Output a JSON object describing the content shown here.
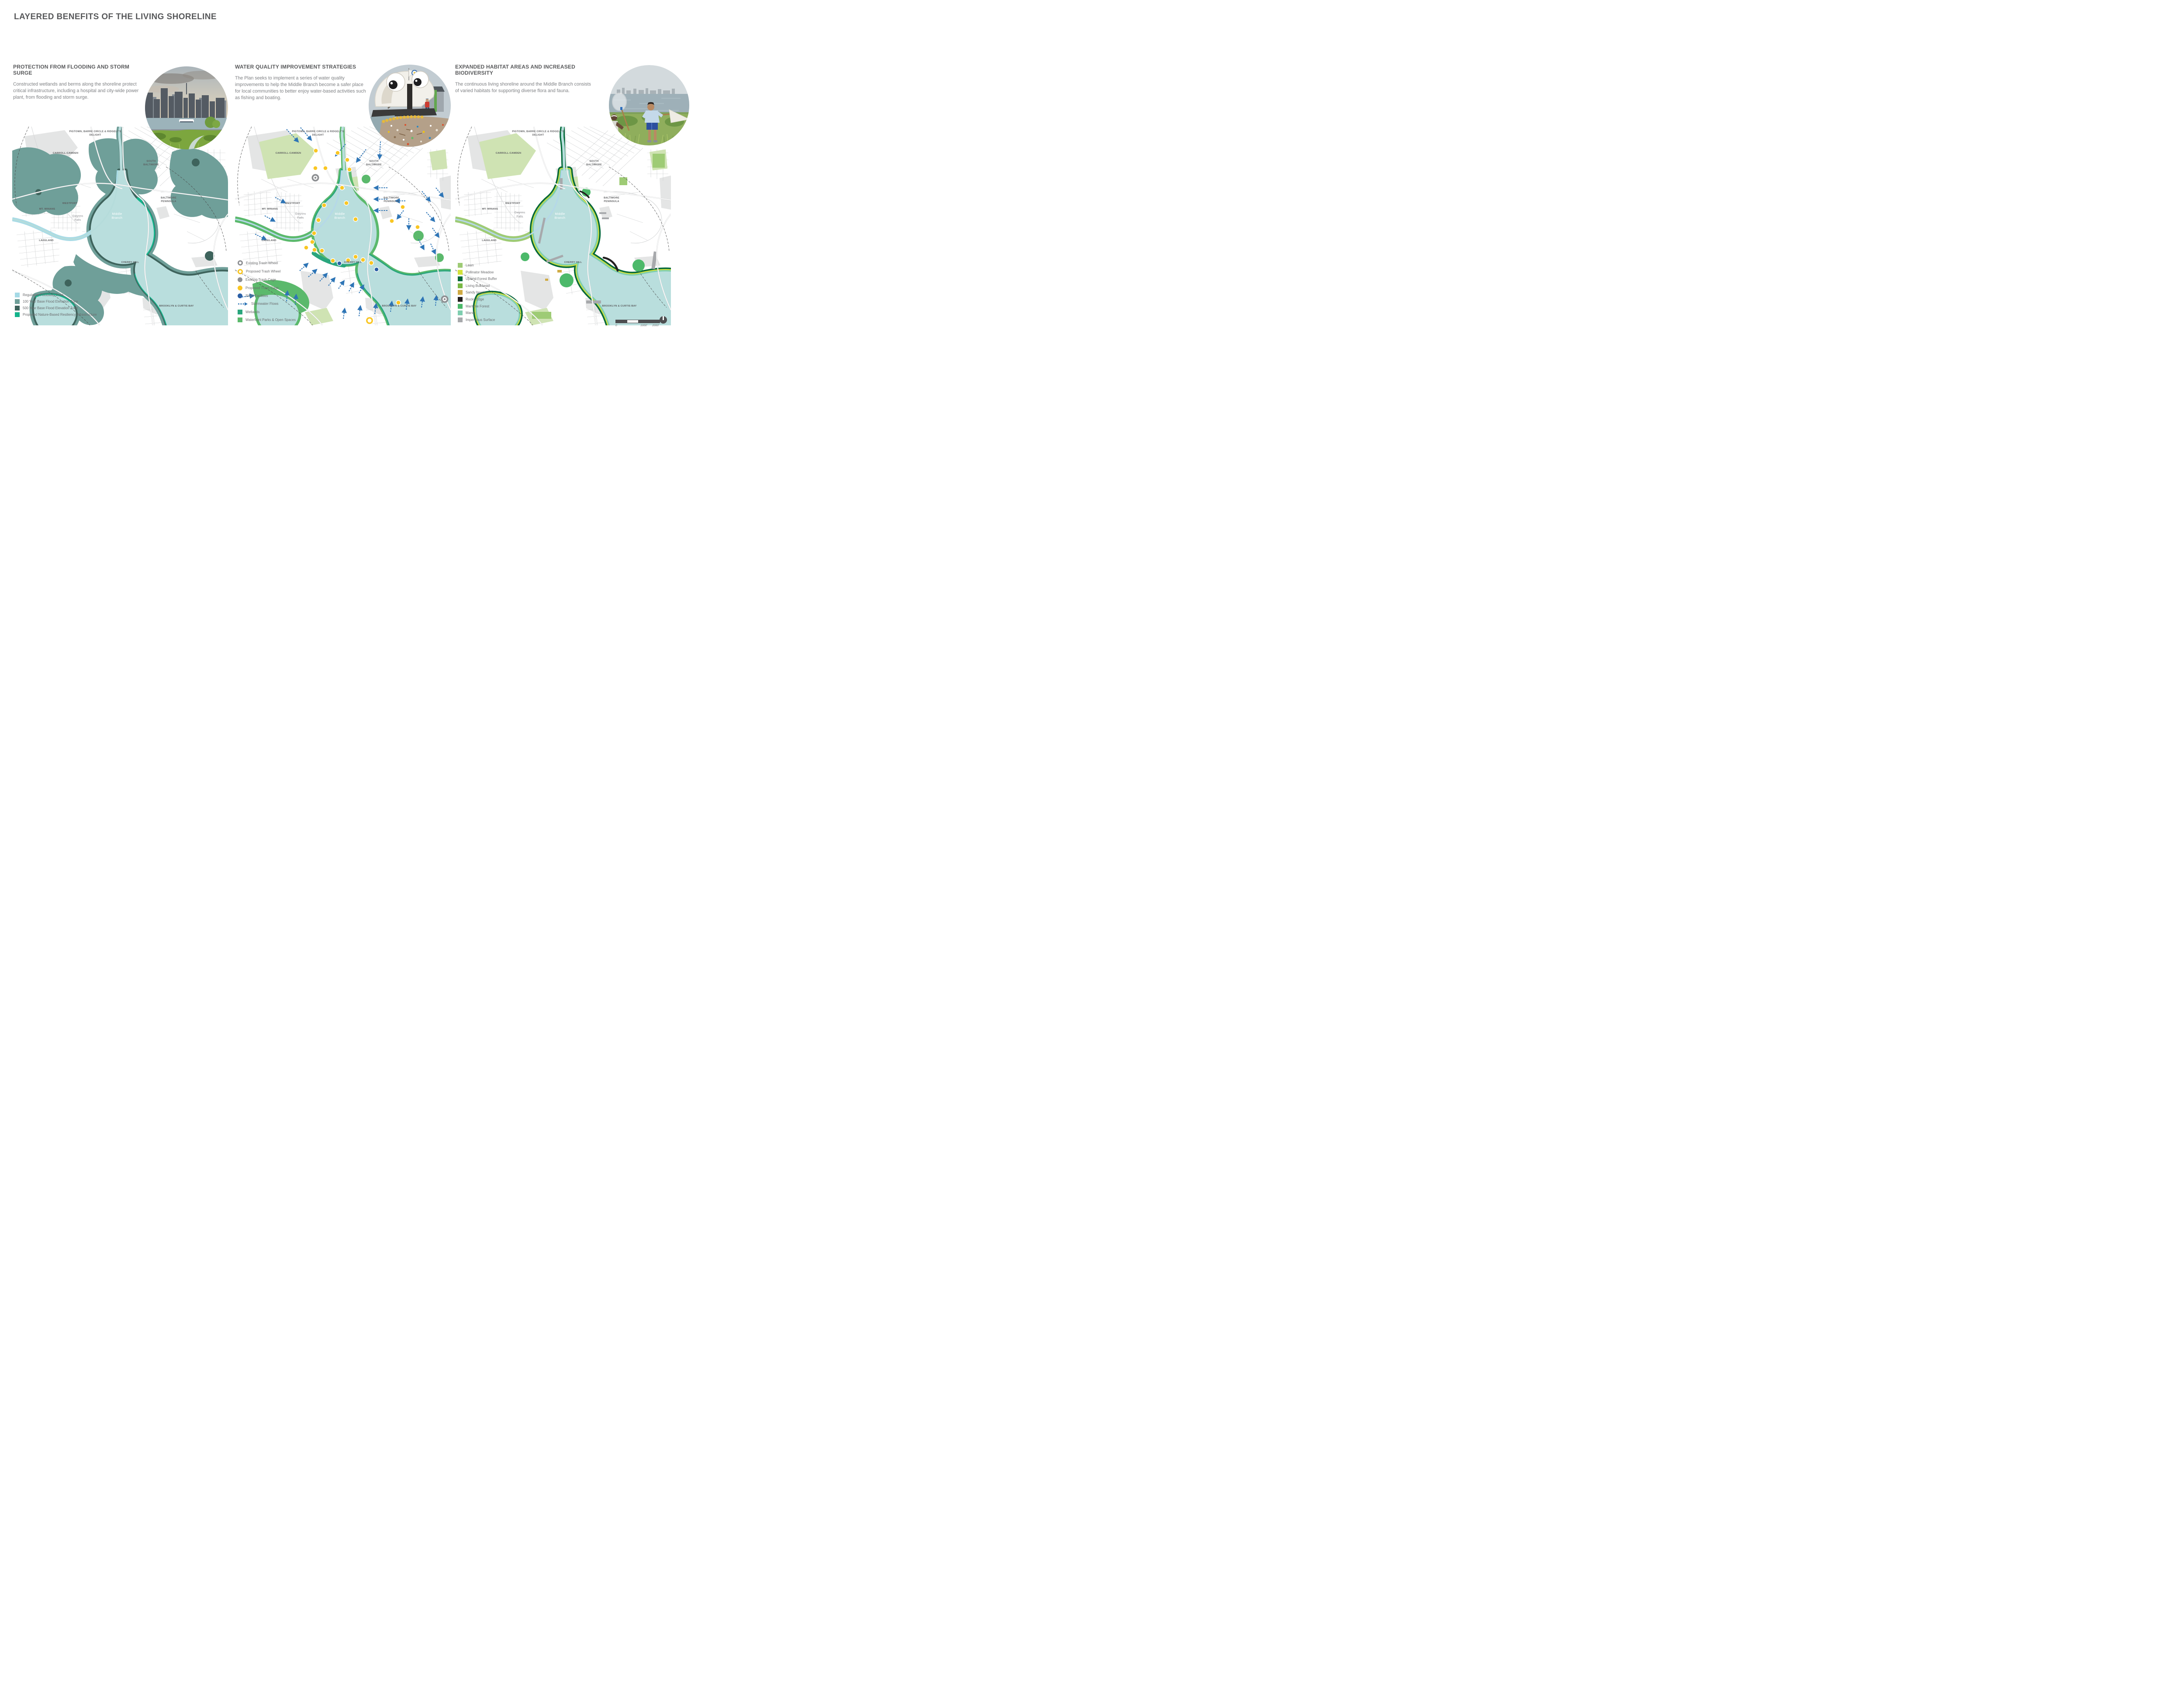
{
  "page_title": "LAYERED BENEFITS OF THE LIVING SHORELINE",
  "panels": [
    {
      "heading": "PROTECTION FROM FLOODING AND STORM SURGE",
      "body": "Constructed wetlands and berms along the shoreline protect critical infrastructure, including a hospital and city-wide power plant, from flooding and storm surge."
    },
    {
      "heading": "WATER QUALITY IMPROVEMENT STRATEGIES",
      "body": "The Plan seeks to implement a series of water quality improvements to help the Middle Branch become a safer place for local communities to better enjoy water-based activities such as fishing and boating."
    },
    {
      "heading": "EXPANDED HABITAT AREAS AND INCREASED BIODIVERSITY",
      "body": "The continuous living shoreline around the Middle Branch consists of varied habitats for supporting diverse flora and fauna."
    }
  ],
  "maps": {
    "labels": {
      "pigtown": "PIGTOWN, BARRE CIRCLE & RIDGELY’S DELIGHT",
      "carroll_camden": "CARROLL-CAMDEN",
      "south_baltimore_1": "SOUTH",
      "south_baltimore_2": "BALTIMORE",
      "baltimore_peninsula_1": "BALTIMORE",
      "baltimore_peninsula_2": "PENINSULA",
      "mt_winans": "MT. WINANS",
      "westport": "WESTPORT",
      "lakeland": "LAKELAND",
      "cherry_hill": "CHERRY HILL",
      "brooklyn_curtis_bay": "BROOKLYN & CURTIS BAY",
      "gwynns_falls_1": "Gwynns",
      "gwynns_falls_2": "Falls",
      "middle_branch_1": "Middle",
      "middle_branch_2": "Branch",
      "patapsco_river_1": "Patapsco",
      "patapsco_river_2": "River"
    }
  },
  "legends": {
    "flood": {
      "items": [
        {
          "label": "Regulatory Floodway Zone",
          "color": "#a5dae6"
        },
        {
          "label": "100 Year Base Flood Elevation Zone",
          "color": "#6f9f99"
        },
        {
          "label": "500 Year Base Flood Elevation Zone",
          "color": "#3e635c"
        },
        {
          "label": "Proposed Nature-Based Resiliency Infrastructure",
          "color": "#14b38b"
        }
      ]
    },
    "water_quality": {
      "items": [
        {
          "label": "Existing Trash Wheel",
          "color": "#8d8f92",
          "icon": "ring"
        },
        {
          "label": "Proposed Trash Wheel",
          "color": "#f9c623",
          "icon": "ring"
        },
        {
          "label": "Existing Trash Cage",
          "color": "#8d8f92",
          "icon": "dot"
        },
        {
          "label": "Proposed Trash Cage",
          "color": "#f9c623",
          "icon": "dot"
        },
        {
          "label": "SWM Facilities",
          "color": "#2b5fa5",
          "icon": "dot"
        },
        {
          "label": "Stormwater Flows",
          "color": "#2e75b6",
          "icon": "dashed-arrow"
        },
        {
          "label": "Wetlands",
          "color": "#2aa67d",
          "icon": "swatch"
        },
        {
          "label": "Waterfront Parks & Open Spaces",
          "color": "#5bb96c",
          "icon": "swatch"
        }
      ]
    },
    "habitat": {
      "items": [
        {
          "label": "Lawn",
          "color": "#9ecb75"
        },
        {
          "label": "Pollinator Meadow",
          "color": "#d3e23a"
        },
        {
          "label": "Upland Forest Buffer",
          "color": "#06693b"
        },
        {
          "label": "Living Bulkhead",
          "color": "#79b844"
        },
        {
          "label": "Sandy beach",
          "color": "#d0ab44"
        },
        {
          "label": "Rocky Edge",
          "color": "#231f20"
        },
        {
          "label": "Maritime Forest",
          "color": "#4cb96a"
        },
        {
          "label": "Marsh",
          "color": "#7fceb0"
        },
        {
          "label": "Impervious Surface",
          "color": "#a7a9ac"
        }
      ]
    }
  },
  "scale_bar": {
    "start": "0",
    "mid": "1000'",
    "end": "2000'"
  },
  "colors": {
    "water": "#b9dedd",
    "stream": "#a9dbe6",
    "flood_100yr": "#6f9f99",
    "flood_500yr": "#3e635c",
    "proposed_resiliency": "#14b38b",
    "wetlands": "#2aa67d",
    "waterfront_parks": "#5bb96c",
    "marker_yellow": "#f9c623",
    "marker_gray": "#8d8f92",
    "marker_blue": "#2b5fa5",
    "stormwater_arrow": "#2e75b6",
    "heading_text": "#57585a",
    "body_text": "#7f8184"
  }
}
